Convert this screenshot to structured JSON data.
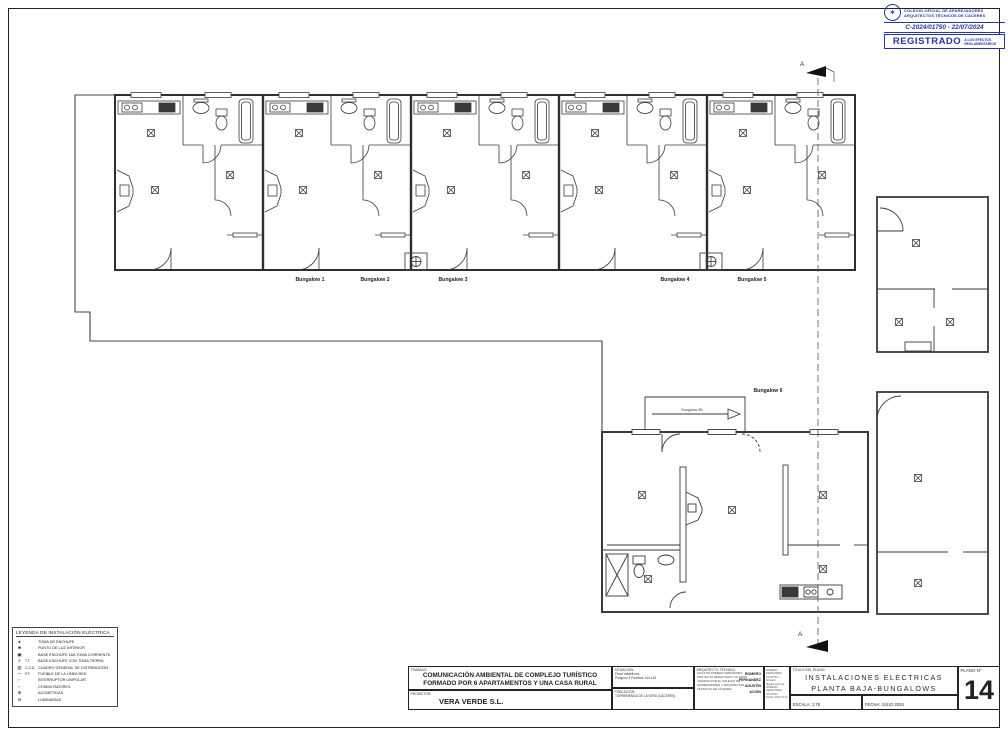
{
  "colors": {
    "accent": "#2736a0",
    "line": "#333333"
  },
  "stamp": {
    "org_line1": "COLEGIO OFICIAL DE APAREJADORES",
    "org_line2": "ARQUITECTOS TÉCNICOS DE CÁCERES",
    "registration": "C-2024/01750 - 22/07/2024",
    "registered": "REGISTRADO",
    "registered_note1": "A LOS EFECTOS",
    "registered_note2": "REGLAMENTARIOS"
  },
  "plan": {
    "section_marker": "A",
    "bungalows": [
      "Bungalow 1",
      "Bungalow 2",
      "Bungalow 3",
      "Bungalow 4",
      "Bungalow 5",
      "Bungalow 6"
    ],
    "arrow_label": "Bungalow 6B"
  },
  "legend": {
    "title": "LEYENDA DE INSTALACIÓN ELÉCTRICA",
    "items": [
      {
        "sym": "●",
        "code": "",
        "label": "TOMA DE ENCHUFE"
      },
      {
        "sym": "■",
        "code": "",
        "label": "PUNTO DE LUZ INTERIOR"
      },
      {
        "sym": "▣",
        "code": "",
        "label": "BASE ENCHUFE 16A TOMA CORRIENTE"
      },
      {
        "sym": "⏚",
        "code": "T.T.",
        "label": "BASE ENCHUFE CON TOMA TIERRA"
      },
      {
        "sym": "▥",
        "code": "C.G.D.",
        "label": "CUADRO GENERAL DE DISTRIBUCIÓN"
      },
      {
        "sym": "—",
        "code": "P.F.",
        "label": "FUSIBLE DE LA LÍNEA RED"
      },
      {
        "sym": "⌐",
        "code": "",
        "label": "INTERRUPTOR UNIPOLAR"
      },
      {
        "sym": "⌐",
        "code": "",
        "label": "CONMUTADORES"
      },
      {
        "sym": "⊕",
        "code": "",
        "label": "ACOMETIDAS"
      },
      {
        "sym": "⊖",
        "code": "",
        "label": "LUMINARIAS"
      }
    ]
  },
  "titleblock": {
    "trabajo_label": "TRABAJO:",
    "trabajo_line1": "COMUNICACIÓN AMBIENTAL DE COMPLEJO TURÍSTICO",
    "trabajo_line2": "FORMADO POR 6 APARTAMENTOS Y UNA CASA RURAL",
    "promotor_label": "PROMOTOR:",
    "promotor": "VERA VERDE S.L.",
    "situacion_label": "SITUACIÓN:",
    "situacion_line1": "Finca Valdeflores",
    "situacion_line2": "Polígono 3 Parcelas 144-145",
    "poblacion_label": "POBLACIÓN:",
    "poblacion": "TORREMENGA DE LA VERA (CÁCERES)",
    "arquitecto_label": "ARQUITECTO TÉCNICO:",
    "arquitecto_line1": "AGUSTÍN ROMERO FERNÁNDEZ",
    "arquitecto_line2": "PROYECTO REDACTADO Y PLANOS",
    "arquitecto_line3": "VISADOS POR EL COLEGIO DE",
    "arquitecto_line4": "APAREJADORES Y ARQUITECTOS",
    "arquitecto_line5": "TÉCNICOS DE CÁCERES",
    "arq_stamp_1": "ROMERO",
    "arq_stamp_2": "FERNANDEZ",
    "arq_stamp_3": "AGUSTÍN",
    "arq_stamp_4": "ACIÓN",
    "firma_line1": "ROMERO FERNANDEZ",
    "firma_line2": "AGUSTIN — Firmado",
    "firma_line3": "digitalmente por",
    "firma_line4": "ROMERO FERNANDEZ",
    "firma_line5": "AGUSTIN",
    "firma_line6": "Fecha: 2024.07.22",
    "titulo_label": "TÍTULO DEL PLANO:",
    "titulo_line1": "INSTALACIONES ELECTRICAS",
    "titulo_line2": "PLANTA BAJA-BUNGALOWS",
    "escala_label": "ESCALA:",
    "escala": "1:75",
    "fecha_label": "FECHA:",
    "fecha": "JULIO 2024",
    "plano_label": "PLANO Nº",
    "plano_num": "14"
  }
}
